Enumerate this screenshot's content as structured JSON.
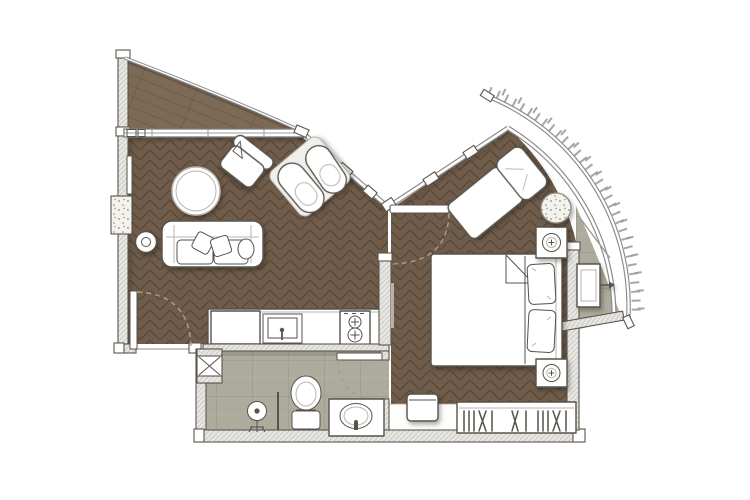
{
  "title": "one-bedroom-apartment-floor-plan",
  "palette": {
    "bg": "#ffffff",
    "wood": "#6f5c4a",
    "plank": "#7c6a57",
    "tile": "#adab9b",
    "wall_fill": "#e8e6e2",
    "wall_hatch": "#c9c6c0",
    "wall_stroke": "#5b564f",
    "glass": "#8c8c8c",
    "furniture_stroke": "#57524c",
    "dash": "#a99c8a",
    "speckle_bg": "#f4f2ed",
    "speckle_dot": "#8e887e",
    "lt": "#b9b5ae"
  },
  "rooms": [
    {
      "name": "terrace-wedge",
      "floor": "wood-plank"
    },
    {
      "name": "living-room",
      "floor": "wood-herringbone"
    },
    {
      "name": "kitchen",
      "floor": "wood-herringbone"
    },
    {
      "name": "bathroom",
      "floor": "stone-tile"
    },
    {
      "name": "bedroom",
      "floor": "wood-herringbone"
    },
    {
      "name": "curved-balcony",
      "floor": "stone-tile"
    }
  ],
  "furniture": {
    "living_room": [
      "sofa",
      "throw-pillows",
      "side-table",
      "round-table",
      "armchair",
      "lounge-chairs-pair",
      "tv-console"
    ],
    "kitchen": [
      "refrigerator",
      "counter",
      "sink",
      "two-burner-cooktop"
    ],
    "bathroom": [
      "service-shaft",
      "shower",
      "toilet",
      "vanity-sink"
    ],
    "bedroom": [
      "double-bed",
      "pillows",
      "nightstand-top",
      "nightstand-bottom",
      "chaise-lounge",
      "round-side-table",
      "stool",
      "wardrobe-with-hangers"
    ],
    "curved_balcony": [
      "ac-unit"
    ]
  },
  "doors": [
    "entry-door-swing",
    "bedroom-pivot-door-swing",
    "bathroom-door-swing"
  ],
  "glazing": [
    "top-window",
    "living-glass-wall",
    "bedroom-glass-wall",
    "curved-glass-wall",
    "balcony-arc-with-ticks"
  ]
}
